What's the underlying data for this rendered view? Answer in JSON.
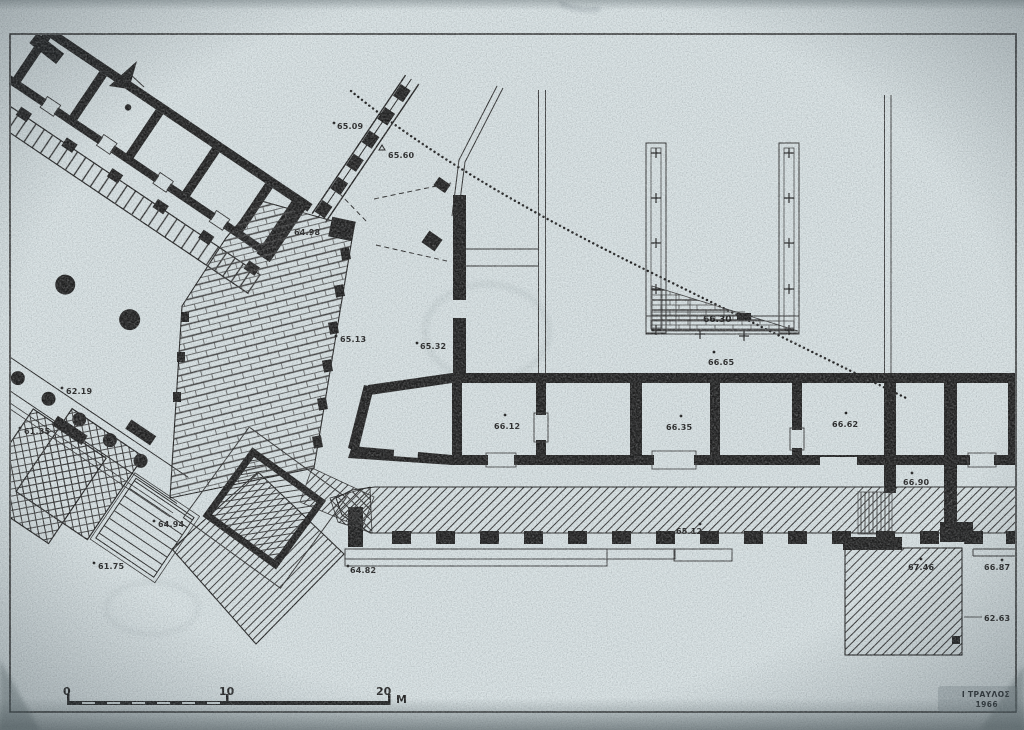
{
  "drawing": {
    "kind": "scanned archaeological site plan",
    "colors": {
      "paper": "#d8e2e4",
      "ink": "#191919"
    }
  },
  "elevations": [
    {
      "text": "65.09"
    },
    {
      "text": "65.60"
    },
    {
      "text": "64.98"
    },
    {
      "text": "65.13"
    },
    {
      "text": "65.32"
    },
    {
      "text": "66.12"
    },
    {
      "text": "66.35"
    },
    {
      "text": "66.62"
    },
    {
      "text": "66.30"
    },
    {
      "text": "66.65"
    },
    {
      "text": "66.90"
    },
    {
      "text": "67.46"
    },
    {
      "text": "66.87"
    },
    {
      "text": "62.63"
    },
    {
      "text": "65.12"
    },
    {
      "text": "64.82"
    },
    {
      "text": "62.19"
    },
    {
      "text": "61.35"
    },
    {
      "text": "64.94"
    },
    {
      "text": "61.75"
    }
  ],
  "scale_bar": {
    "tick_0": "0",
    "tick_10": "10",
    "tick_20": "20",
    "unit": "M"
  },
  "signature": {
    "author": "Ι ΤΡΑΥΛΟΣ",
    "year": "1966"
  }
}
